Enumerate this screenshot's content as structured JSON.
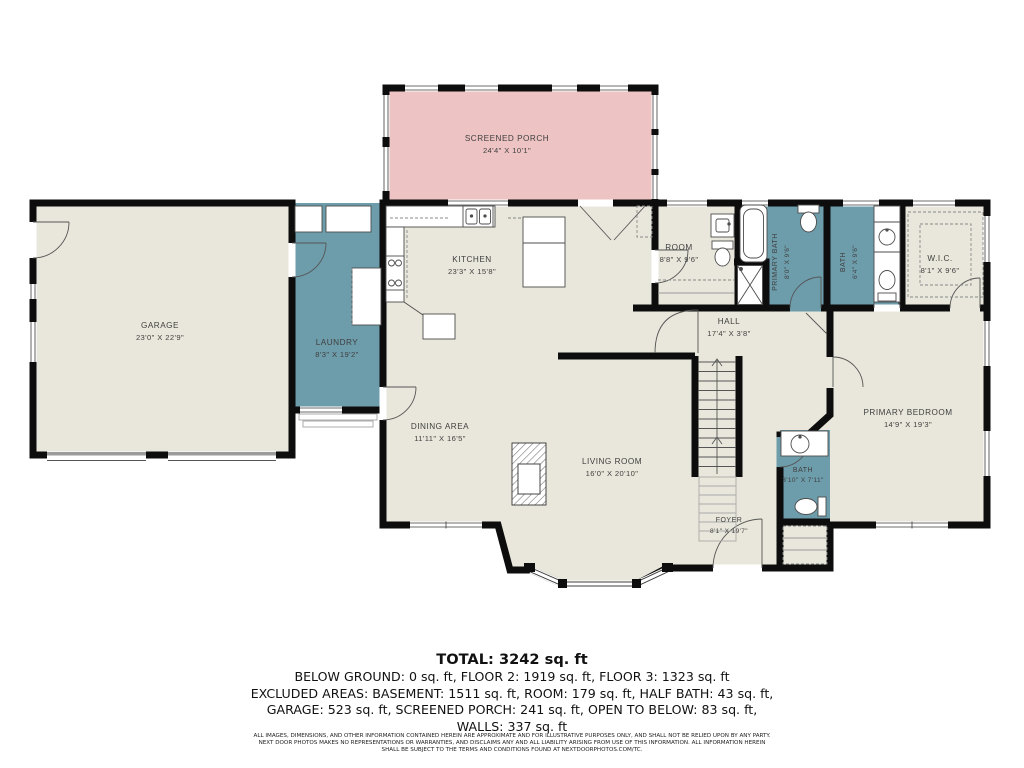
{
  "colors": {
    "room_fill": "#e9e7db",
    "wet_room_fill": "#6d9cab",
    "porch_fill": "#edc3c3",
    "wall": "#0d0d0d",
    "fixture_stroke": "#4d4d4d"
  },
  "plan": {
    "rooms": {
      "screened_porch": {
        "label": "SCREENED PORCH",
        "dims": "24'4\" X 10'1\""
      },
      "kitchen": {
        "label": "KITCHEN",
        "dims": "23'3\" X 15'8\""
      },
      "garage": {
        "label": "GARAGE",
        "dims": "23'0\" X 22'9\""
      },
      "laundry": {
        "label": "LAUNDRY",
        "dims": "8'3\" X 19'2\""
      },
      "room": {
        "label": "ROOM",
        "dims": "8'8\" X 9'6\""
      },
      "primary_bath": {
        "label": "PRIMARY BATH",
        "dims": "8'0\" X 9'6\""
      },
      "bath_upper": {
        "label": "BATH",
        "dims": "6'4\" X 9'6\""
      },
      "wic": {
        "label": "W.I.C.",
        "dims": "8'1\" X 9'6\""
      },
      "hall": {
        "label": "HALL",
        "dims": "17'4\" X 3'8\""
      },
      "primary_bedroom": {
        "label": "PRIMARY BEDROOM",
        "dims": "14'9\" X 19'3\""
      },
      "dining_area": {
        "label": "DINING AREA",
        "dims": "11'11\" X 16'5\""
      },
      "living_room": {
        "label": "LIVING ROOM",
        "dims": "16'0\" X 20'10\""
      },
      "bath_lower": {
        "label": "BATH",
        "dims": "3'10\" X 7'11\""
      },
      "foyer": {
        "label": "FOYER",
        "dims": "8'1\" X 19'7\""
      }
    }
  },
  "summary": {
    "total": "TOTAL: 3242 sq. ft",
    "line1": "BELOW GROUND: 0 sq. ft, FLOOR 2: 1919 sq. ft, FLOOR 3: 1323 sq. ft",
    "line2": "EXCLUDED AREAS: BASEMENT: 1511 sq. ft, ROOM: 179 sq. ft, HALF BATH: 43 sq. ft,",
    "line3": "GARAGE: 523 sq. ft, SCREENED PORCH: 241 sq. ft, OPEN TO BELOW: 83 sq. ft,",
    "line4": "WALLS: 337 sq. ft"
  },
  "disclaimer": {
    "line1": "ALL IMAGES, DIMENSIONS, AND OTHER INFORMATION CONTAINED HEREIN ARE APPROXIMATE AND FOR ILLUSTRATIVE PURPOSES ONLY, AND SHALL NOT BE RELIED UPON BY ANY PARTY.",
    "line2": "NEXT DOOR PHOTOS MAKES NO REPRESENTATIONS OR WARRANTIES, AND DISCLAIMS ANY AND ALL LIABILITY ARISING FROM USE OF THIS INFORMATION. ALL INFORMATION HEREIN",
    "line3": "SHALL BE SUBJECT TO THE TERMS AND CONDITIONS FOUND AT NEXTDOORPHOTOS.COM/TC."
  }
}
